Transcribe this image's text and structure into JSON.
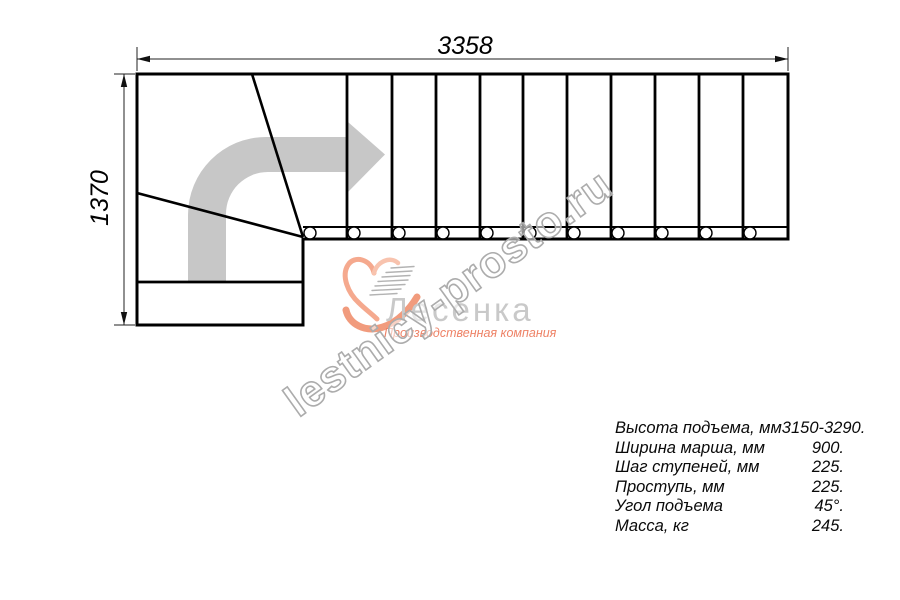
{
  "drawing": {
    "width_dimension": "3358",
    "height_dimension": "1370"
  },
  "watermark": {
    "text": "lestnicy-prosto.ru"
  },
  "logo": {
    "name": "Лесенка",
    "tagline": "Производственная компания"
  },
  "specs": {
    "rows": [
      {
        "label": "Высота подъема, мм",
        "value": "3150-3290."
      },
      {
        "label": "Ширина марша, мм",
        "value": "900."
      },
      {
        "label": "Шаг ступеней, мм",
        "value": "225."
      },
      {
        "label": "Проступь, мм",
        "value": "225."
      },
      {
        "label": "Угол подъема",
        "value": "45°."
      },
      {
        "label": "Масса, кг",
        "value": "245."
      }
    ]
  },
  "colors": {
    "line": "#000000",
    "direction_arrow": "#c7c7c7",
    "watermark_outline": "#acacac",
    "logo_salmon": "#f19b7d",
    "logo_text_gray": "#c9c9c9"
  }
}
